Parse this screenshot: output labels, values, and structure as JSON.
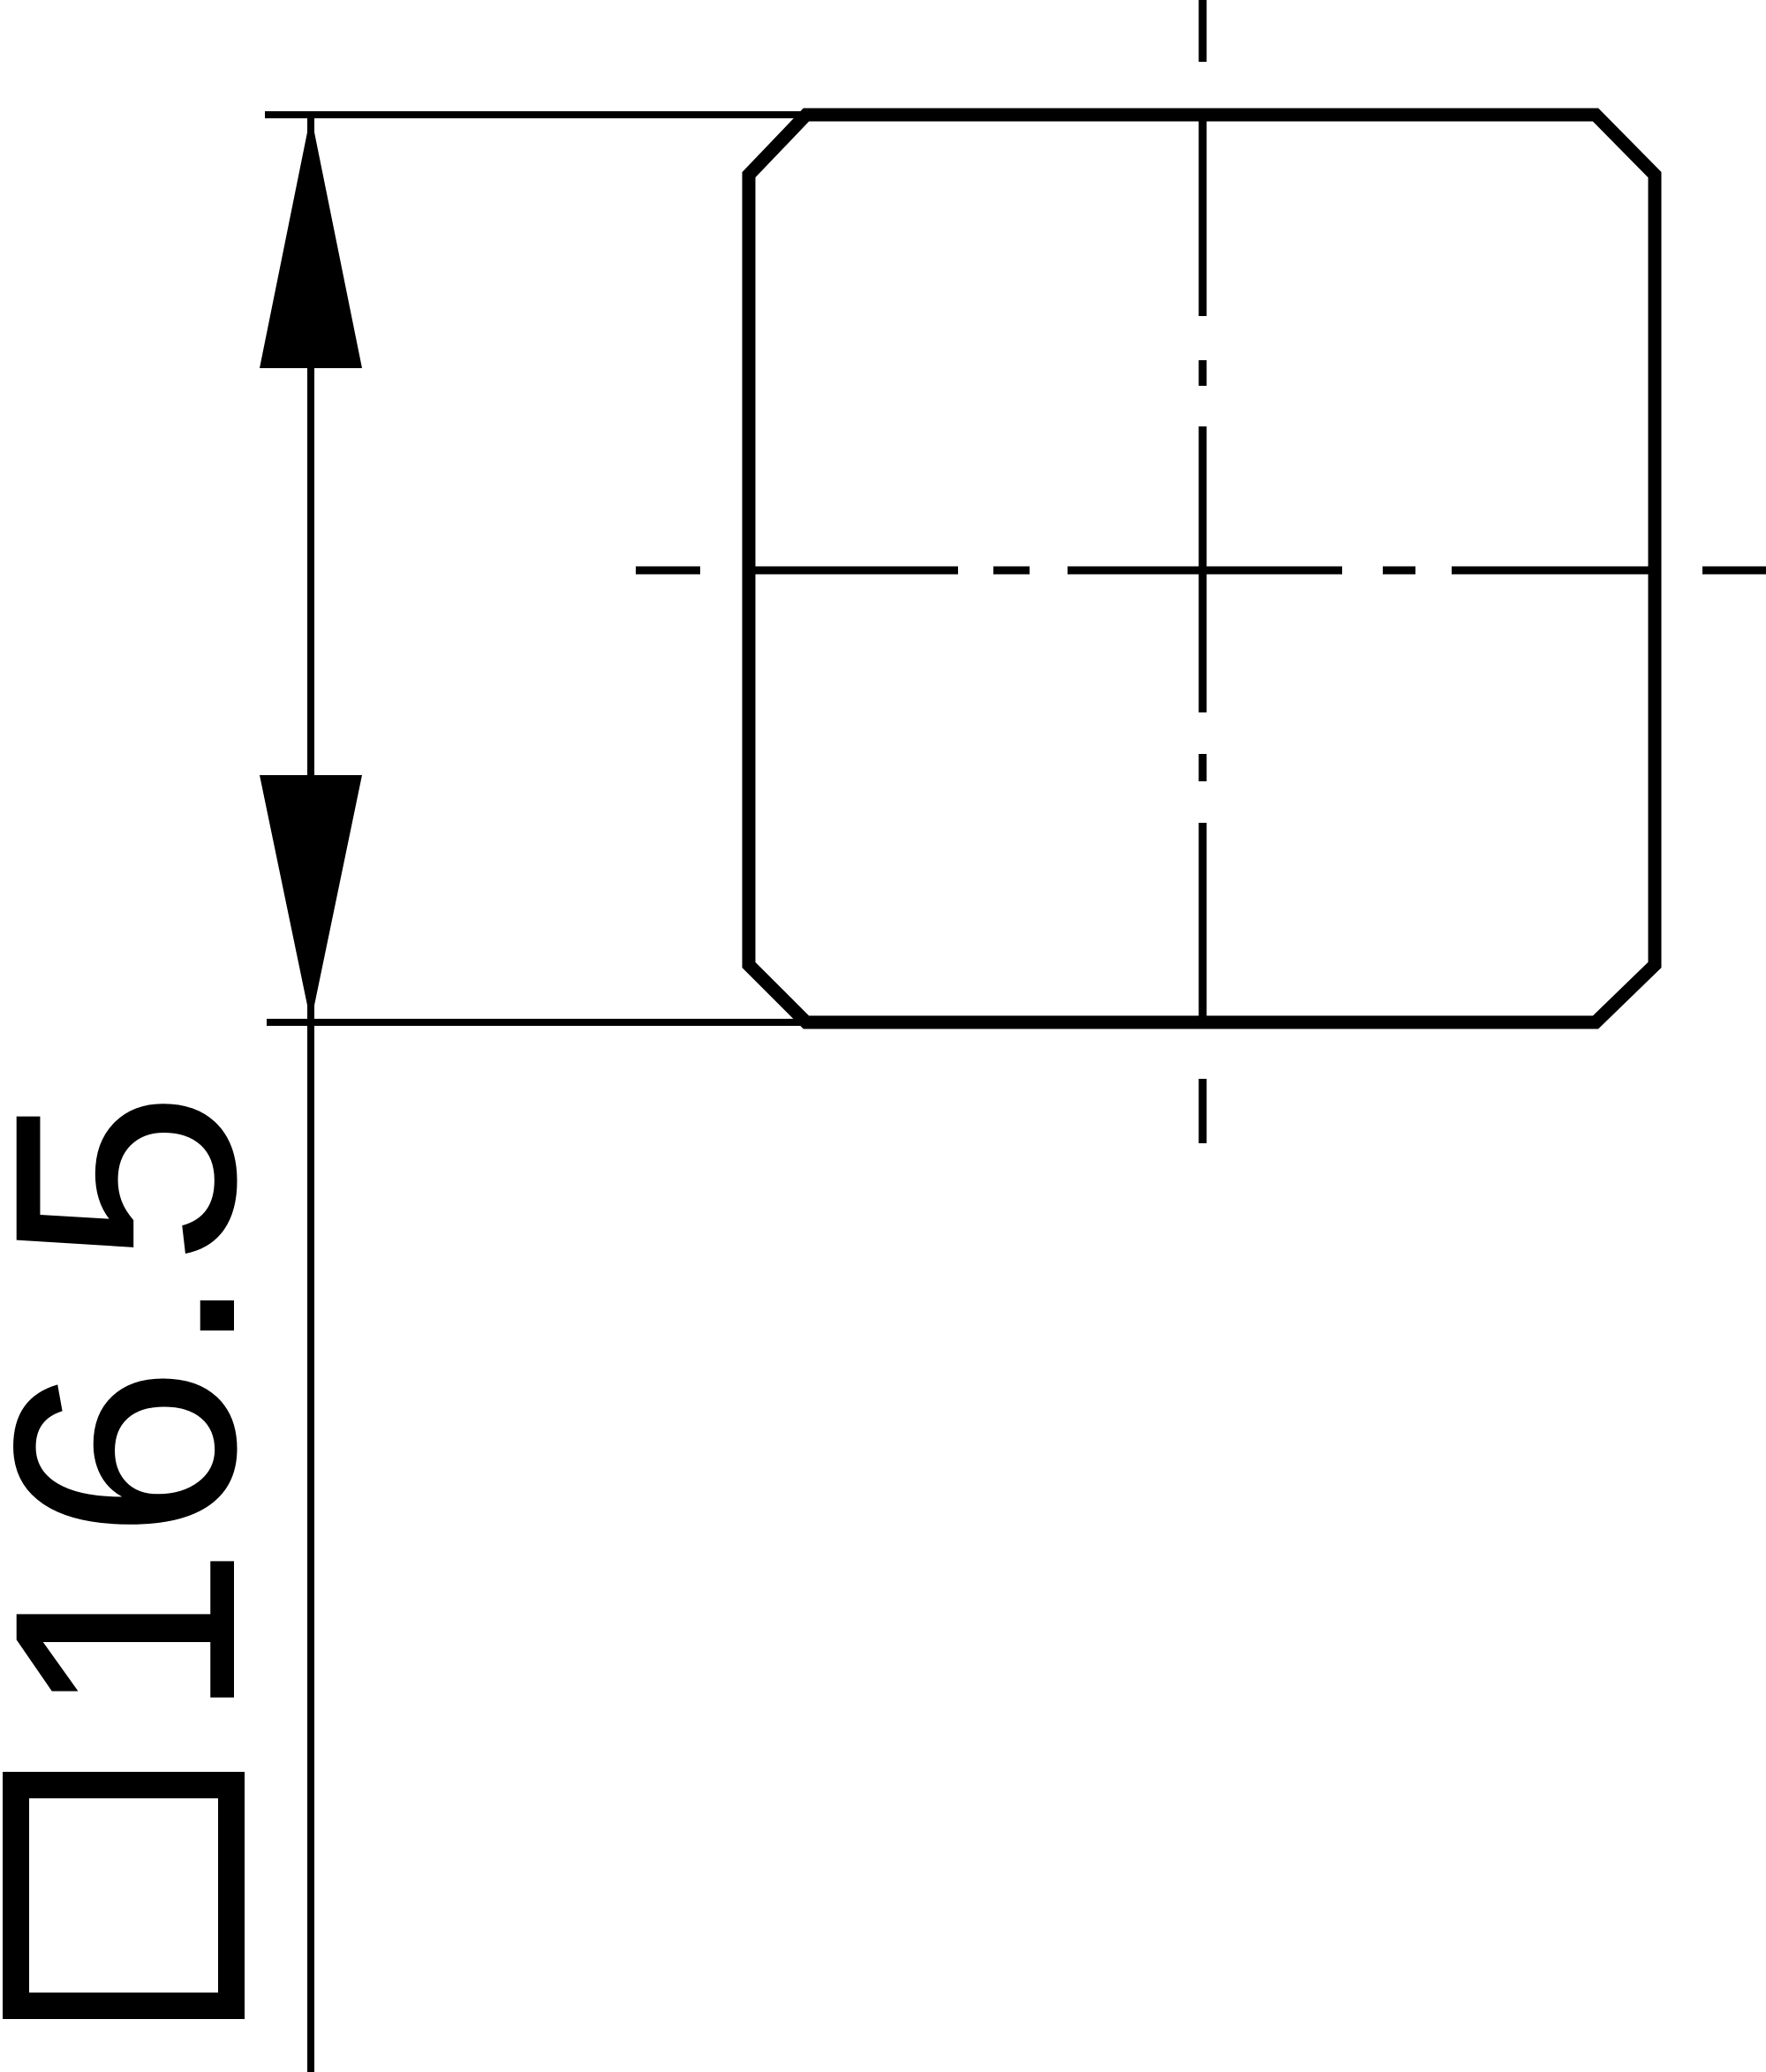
{
  "colors": {
    "background": "#ffffff",
    "lines": "#000000"
  },
  "drawing": {
    "dimension": {
      "symbol": "square-section",
      "symbol_glyph": "□",
      "value": "16.5"
    }
  }
}
